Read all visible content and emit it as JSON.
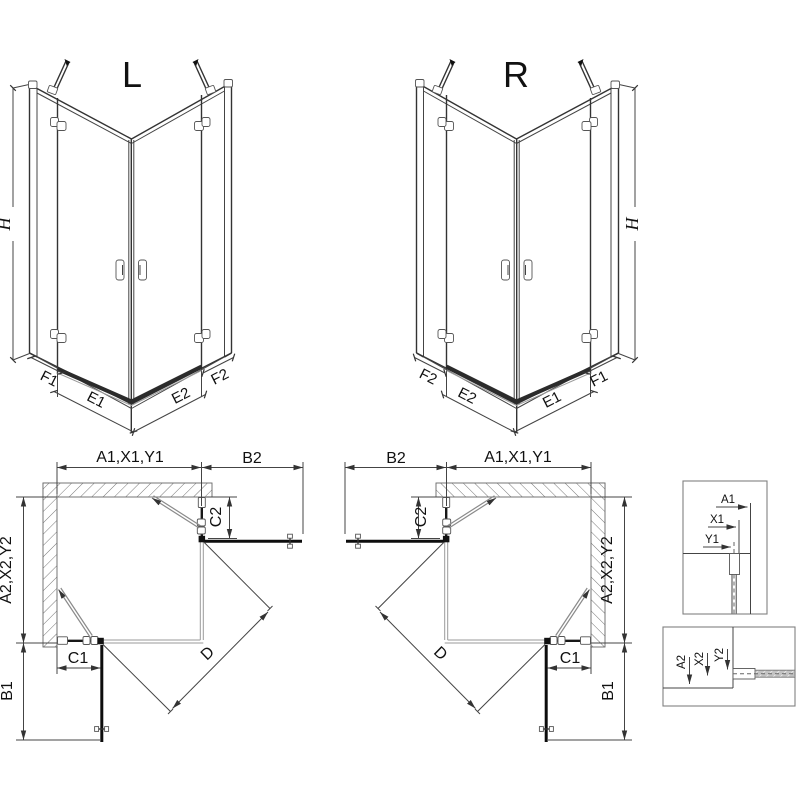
{
  "colors": {
    "line": "#333333",
    "dark_line": "#111111",
    "background": "#ffffff",
    "hatch": "#777777"
  },
  "labels": {
    "iso_left": {
      "variant": "L",
      "height": "H",
      "f1": "F1",
      "e1": "E1",
      "e2": "E2",
      "f2": "F2"
    },
    "iso_right": {
      "variant": "R",
      "height": "H",
      "f1": "F1",
      "e1": "E1",
      "e2": "E2",
      "f2": "F2"
    },
    "plan_left": {
      "top_width": "A1,X1,Y1",
      "open_door_top": "B2",
      "fixed_top": "C2",
      "side_width": "A2,X2,Y2",
      "fixed_bottom": "C1",
      "open_door_side": "B1",
      "diagonal": "D"
    },
    "plan_right": {
      "top_width": "A1,X1,Y1",
      "open_door_top": "B2",
      "fixed_top": "C2",
      "side_width": "A2,X2,Y2",
      "fixed_bottom": "C1",
      "open_door_side": "B1",
      "diagonal": "D"
    },
    "detail_top": {
      "a1": "A1",
      "x1": "X1",
      "y1": "Y1"
    },
    "detail_bottom": {
      "a2": "A2",
      "x2": "X2",
      "y2": "Y2"
    }
  }
}
